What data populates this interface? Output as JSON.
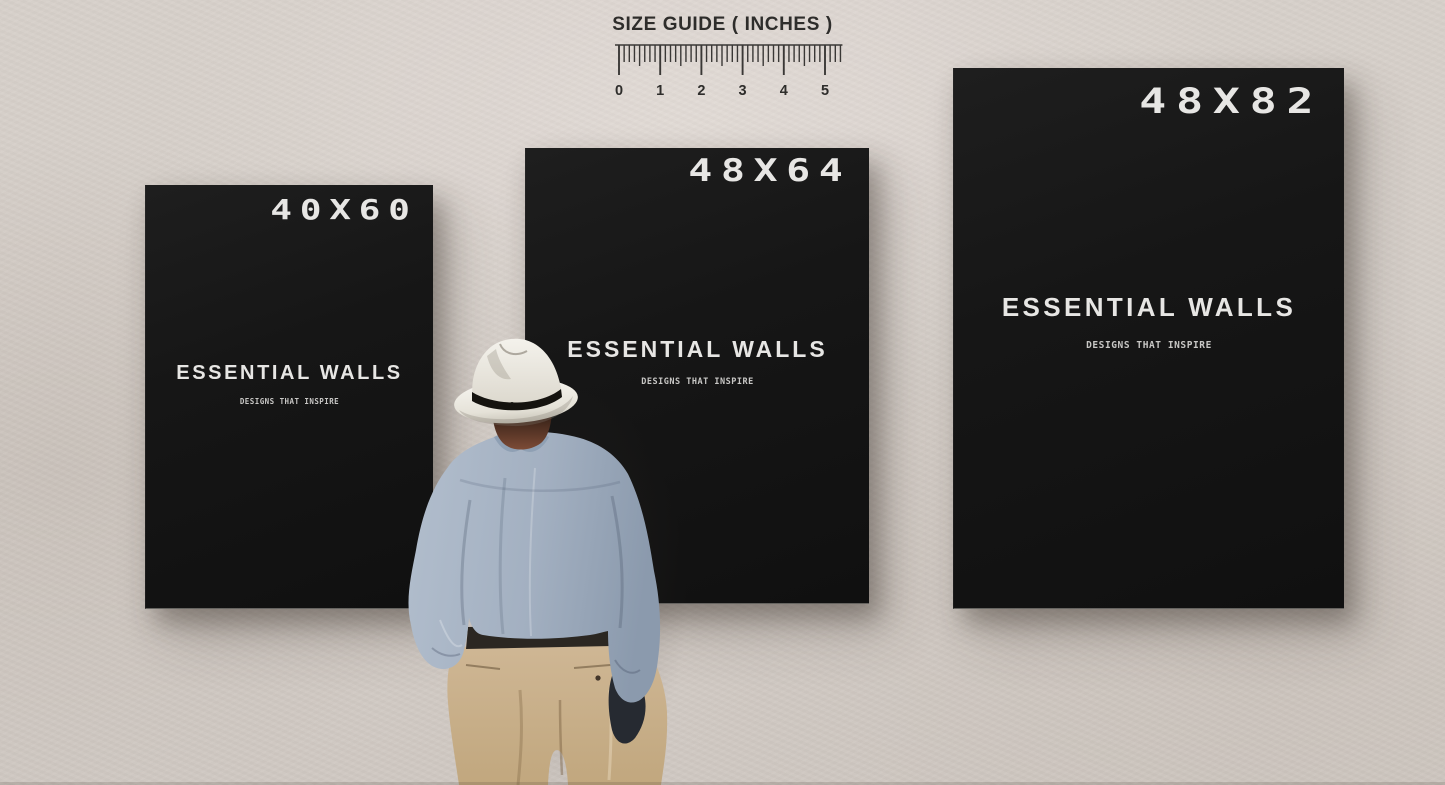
{
  "size_guide": {
    "title": "SIZE GUIDE ( INCHES )",
    "ruler": {
      "labels": [
        "0",
        "1",
        "2",
        "3",
        "4",
        "5"
      ],
      "inches": 5,
      "subdivisions_per_inch": 8
    }
  },
  "posters": [
    {
      "size": "40X60",
      "brand": "ESSENTIAL WALLS",
      "tagline": "DESIGNS THAT INSPIRE"
    },
    {
      "size": "48X64",
      "brand": "ESSENTIAL WALLS",
      "tagline": "DESIGNS THAT INSPIRE"
    },
    {
      "size": "48X82",
      "brand": "ESSENTIAL WALLS",
      "tagline": "DESIGNS THAT INSPIRE"
    }
  ],
  "colors": {
    "wall": "#d8d1cb",
    "poster_bg": "#161616",
    "poster_text": "#e7e6e4",
    "tagline_text": "#c8c7c5",
    "ruler_text": "#2e2d2b",
    "hat": "#efede6",
    "hat_band": "#15130f",
    "shirt": "#a3b0c1",
    "pants": "#c9b18d"
  }
}
